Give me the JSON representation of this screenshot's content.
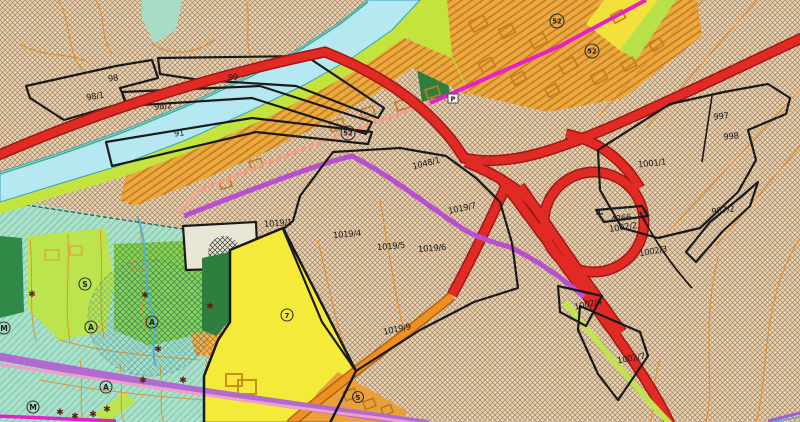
{
  "labels": {
    "p98": "98",
    "p98_1": "98/1",
    "p98_2": "98/2",
    "p91": "91",
    "p99": "99",
    "p1048_1": "1048/1",
    "p1019_1": "1019/1",
    "p1019_4": "1019/4",
    "p1019_5": "1019/5",
    "p1019_6": "1019/6",
    "p1019_7": "1019/7",
    "p1019_9": "1019/9",
    "p997": "997",
    "p998": "998",
    "p1001_1": "1001/1",
    "p987_2": "987/2",
    "p4266": "4266",
    "p1002_2": "1002/2",
    "p1002_3": "1002/3",
    "p1002_4": "1002/4",
    "p1002_7": "1002/7"
  },
  "markers": {
    "zone52": "52",
    "zone7": "7",
    "zone5": "5",
    "zoneS": "S",
    "zoneA": "A",
    "zoneM": "M",
    "parking": "P"
  },
  "symbols": {
    "asterisk": "✱",
    "cross": "+"
  },
  "colors": {
    "background_hatch": "#eed2ac",
    "hatch_line": "#77675a",
    "river": "#b6e8f2",
    "riverbank_green": "#c3e43c",
    "builtup_orange": "#ecaa3e",
    "residential_yellow": "#f2e13a",
    "parcel_yellow": "#f4ea3a",
    "greenbelt_teal": "#aadfca",
    "forest_dark_green": "#2e7e40",
    "meadow_green": "#8ed158",
    "motorway_red": "#e12a24",
    "road_orange": "#ef8f22",
    "planned_road_violet": "#b84fd0",
    "planned_line_magenta": "#e620c8",
    "local_road_purple": "#b06ad0",
    "pink_line": "#f0a0c8",
    "parcel_outline": "#1a1a1a",
    "beige_parcel": "#eae6d6"
  }
}
